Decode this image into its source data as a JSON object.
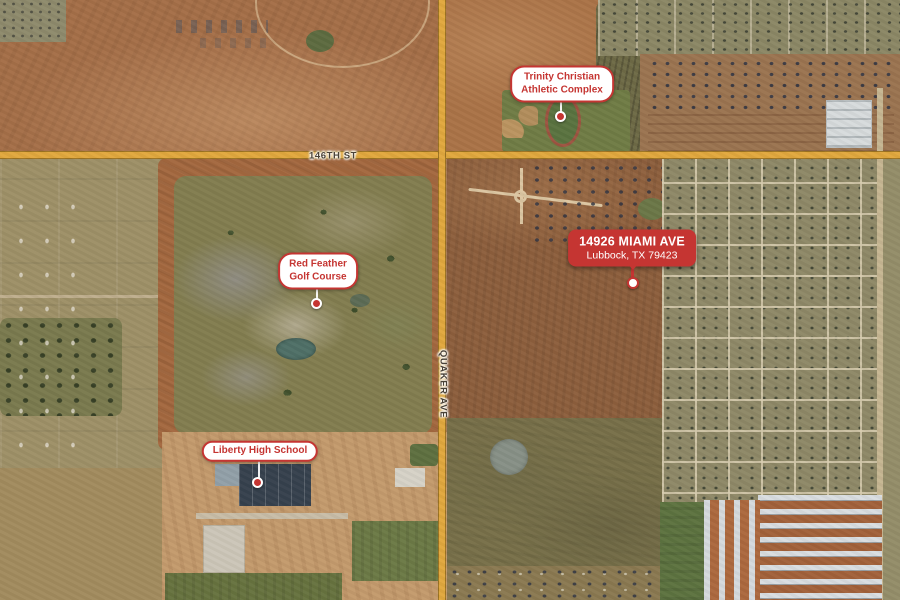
{
  "map": {
    "view": "satellite"
  },
  "streets": {
    "h146": {
      "label": "146TH ST"
    },
    "quaker": {
      "label": "QUAKER AVE"
    }
  },
  "markers": {
    "trinity": {
      "line1": "Trinity Christian",
      "line2": "Athletic Complex"
    },
    "red_feather": {
      "line1": "Red Feather",
      "line2": "Golf Course"
    },
    "liberty": {
      "line1": "Liberty High School"
    },
    "address": {
      "line1": "14926 MIAMI AVE",
      "line2": "Lubbock, TX 79423"
    }
  },
  "colors": {
    "accent_red": "#c53532",
    "pill_bg": "#ffffff",
    "road_yellow": "#e1a83e"
  }
}
